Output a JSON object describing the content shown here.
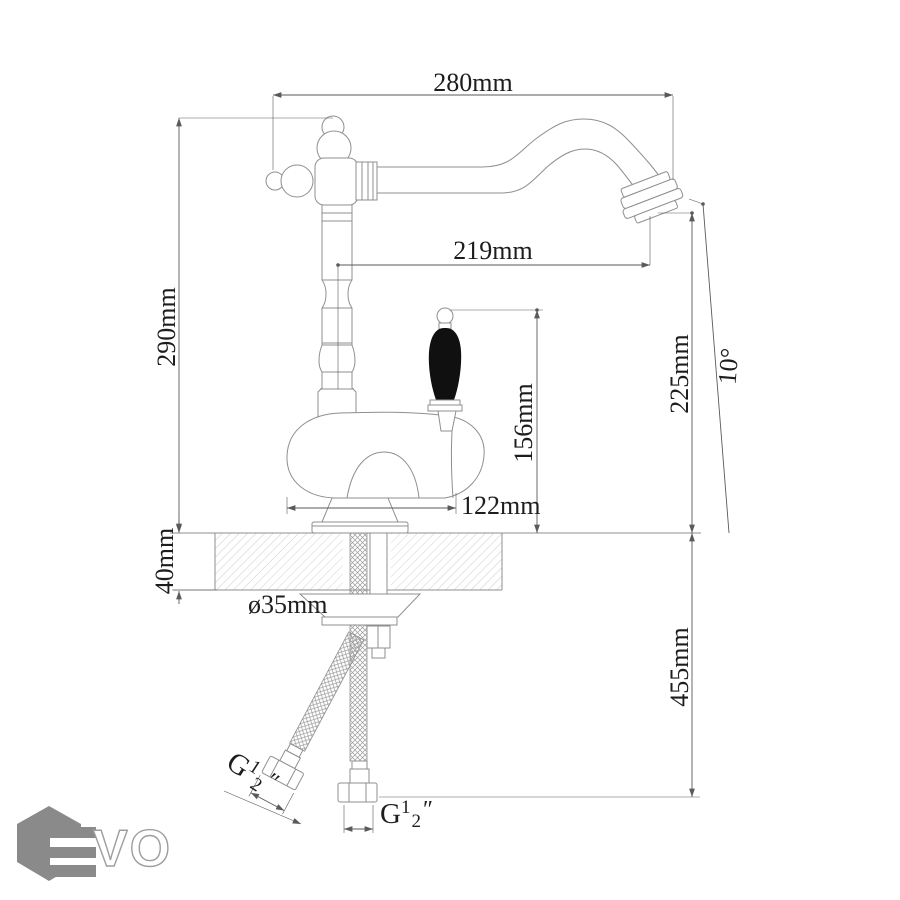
{
  "colors": {
    "outline": "#8f8f8f",
    "dimension": "#5a5a5a",
    "text": "#1d1d1d",
    "handle": "#101010",
    "logo_gray": "#8a8a8a"
  },
  "dimensions": {
    "spout_reach": "280mm",
    "spout_projection": "219mm",
    "total_height": "290mm",
    "outlet_height": "225mm",
    "tilt_angle": "10°",
    "handle_height": "156mm",
    "body_length": "122mm",
    "deck_thickness": "40mm",
    "hole_diameter": "ø35mm",
    "hose_drop": "455mm",
    "thread_vertical": {
      "prefix": "G",
      "numerator": "1",
      "denominator": "2",
      "unit": "″"
    },
    "thread_angled": {
      "prefix": "G",
      "numerator": "1",
      "denominator": "2",
      "unit": "″"
    }
  },
  "logo": {
    "letters": "VO"
  }
}
